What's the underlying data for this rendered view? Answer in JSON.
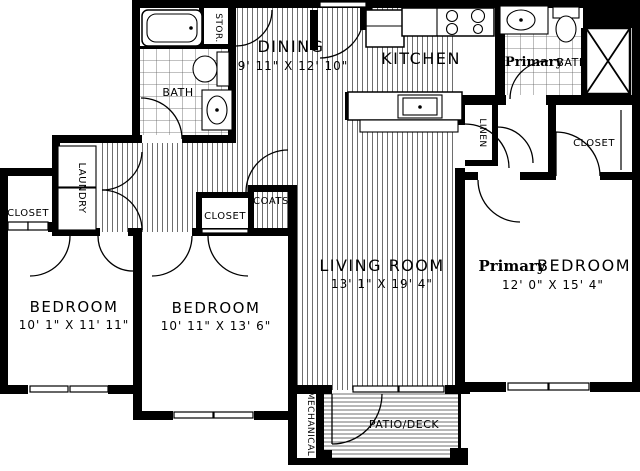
{
  "plan": {
    "title": "Two-bedroom-plus-primary apartment floor plan",
    "rooms": {
      "dining": {
        "name": "DINING",
        "dims": "9' 11\" X 12' 10\""
      },
      "kitchen": {
        "name": "KITCHEN"
      },
      "bath": {
        "name": "BATH"
      },
      "primary_bath": {
        "prefix": "Primary",
        "name": "BATH"
      },
      "living_room": {
        "name": "LIVING ROOM",
        "dims": "13' 1\" X 19' 4\""
      },
      "primary_bedroom": {
        "prefix": "Primary",
        "name": "BEDROOM",
        "dims": "12' 0\" X 15' 4\""
      },
      "bedroom_1": {
        "name": "BEDROOM",
        "dims": "10' 1\" X 11' 11\""
      },
      "bedroom_2": {
        "name": "BEDROOM",
        "dims": "10' 11\" X 13' 6\""
      },
      "mechanical": {
        "name": "MECHANICAL"
      },
      "patio": {
        "name": "PATIO/DECK"
      }
    },
    "closets": {
      "stor": "STOR.",
      "linen": "LINEN",
      "laundry": "LAUNDRY",
      "coats": "COATS",
      "closet_bedroom_1": "CLOSET",
      "closet_bedroom_2": "CLOSET",
      "closet_primary": "CLOSET"
    },
    "colors": {
      "wall": "#000000",
      "background": "#ffffff",
      "floor_hatch": "#4a4a4a",
      "tile_grid": "#5a5a5a"
    }
  }
}
